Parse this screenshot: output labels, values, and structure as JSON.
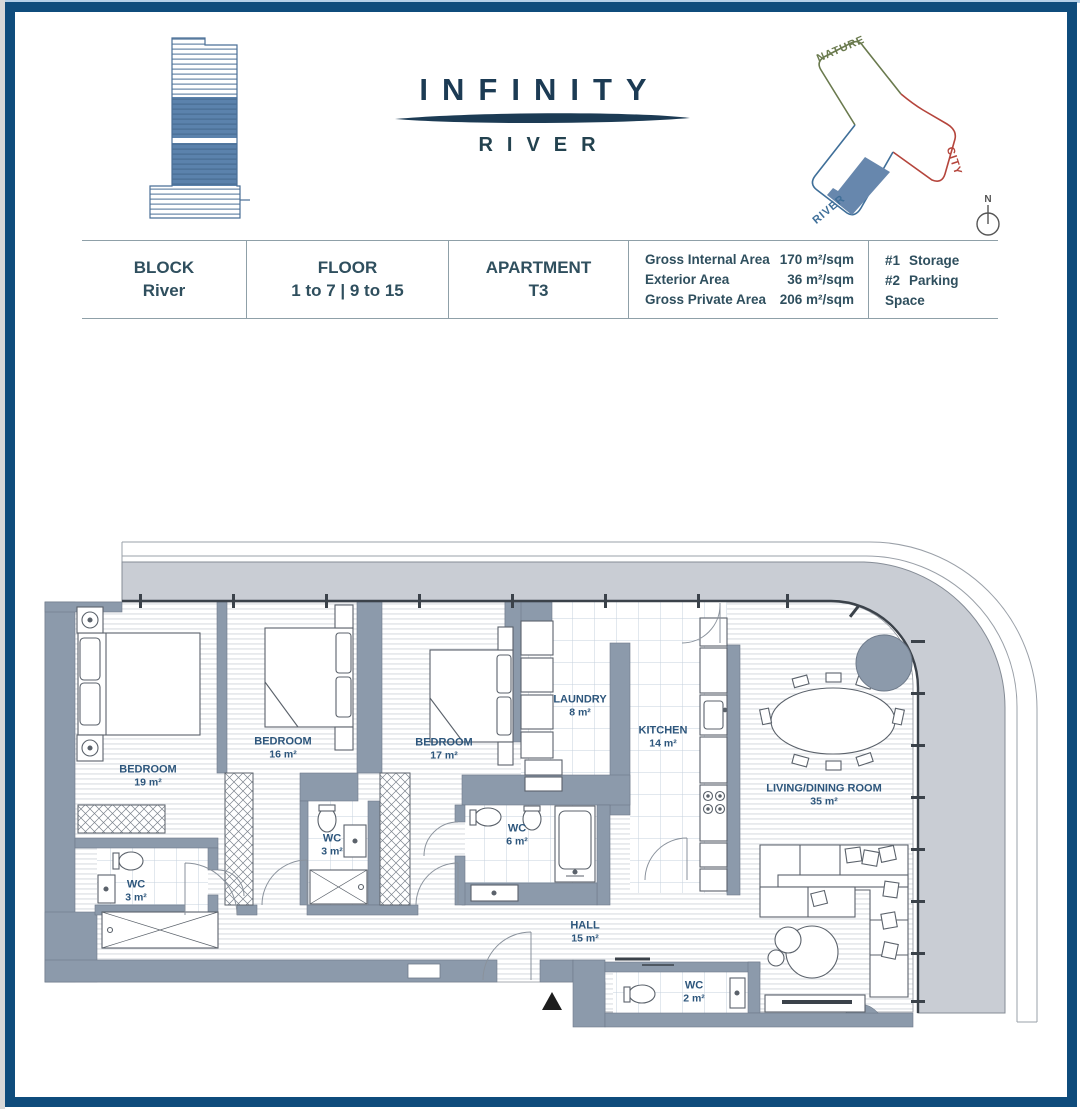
{
  "header": {
    "brand_title": "INFINITY",
    "brand_subtitle": "RIVER",
    "site_labels": {
      "nature": "NATURE",
      "city": "CITY",
      "river": "RIVER"
    },
    "compass_label": "N"
  },
  "info_table": {
    "columns": [
      {
        "label": "BLOCK",
        "value": "River"
      },
      {
        "label": "FLOOR",
        "value": "1 to 7 | 9 to 15"
      },
      {
        "label": "APARTMENT",
        "value": "T3"
      }
    ],
    "areas": [
      {
        "label": "Gross Internal Area",
        "value": "170 m²/sqm"
      },
      {
        "label": "Exterior Area",
        "value": "36 m²/sqm"
      },
      {
        "label": "Gross Private Area",
        "value": "206 m²/sqm"
      }
    ],
    "extras": [
      {
        "tag": "#1",
        "label": "Storage"
      },
      {
        "tag": "#2",
        "label": "Parking Space"
      }
    ]
  },
  "plan": {
    "rooms": [
      {
        "name": "BEDROOM",
        "area": "19 m²"
      },
      {
        "name": "BEDROOM",
        "area": "16 m²"
      },
      {
        "name": "BEDROOM",
        "area": "17 m²"
      },
      {
        "name": "LAUNDRY",
        "area": "8 m²"
      },
      {
        "name": "KITCHEN",
        "area": "14 m²"
      },
      {
        "name": "WC",
        "area": "3 m²"
      },
      {
        "name": "WC",
        "area": "3 m²"
      },
      {
        "name": "WC",
        "area": "6 m²"
      },
      {
        "name": "HALL",
        "area": "15 m²"
      },
      {
        "name": "WC",
        "area": "2 m²"
      },
      {
        "name": "LIVING/DINING ROOM",
        "area": "35 m²"
      }
    ]
  }
}
